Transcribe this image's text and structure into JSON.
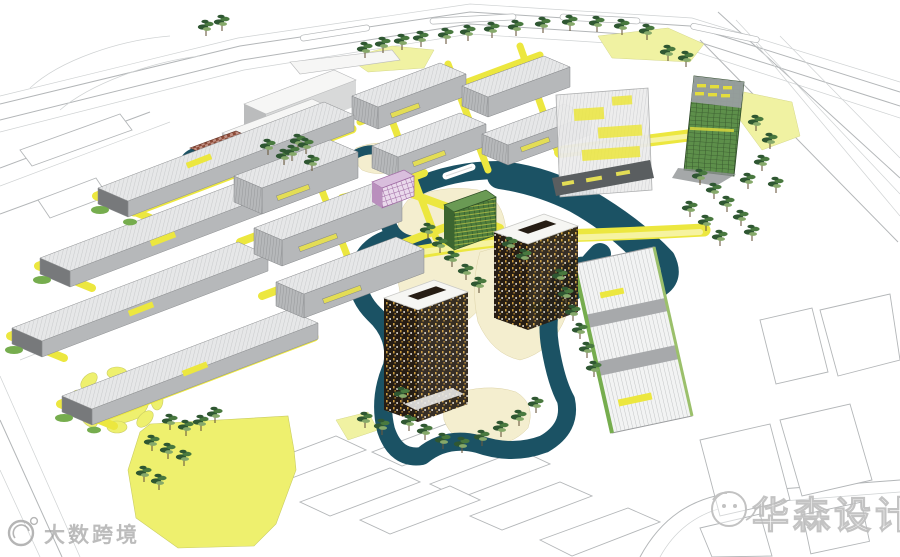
{
  "watermarks": {
    "bottom_left_text": "大数跨境",
    "bottom_right_text": "华森设计",
    "bottom_left_logo": "swirl-circle-logo",
    "bottom_right_logo": "face-circle-logo"
  },
  "scene": {
    "kind": "aerial-3d-masterplan-rendering",
    "elements": [
      "perimeter-roads-linework",
      "warehouse-district",
      "midrise-cluster",
      "top-cluster",
      "white-massing-buildings",
      "red-lattice-pavilion",
      "pink-lattice-cube",
      "green-lattice-cube",
      "meandering-river",
      "pond-island",
      "dark-courtyard-tower-upper",
      "dark-courtyard-tower-lower",
      "exhibition-slab",
      "green-glass-tower",
      "ribbed-hall-building",
      "yellow-walkway-network",
      "flower-plaza",
      "big-lawn",
      "tree-rows",
      "future-phase-parcel-outlines"
    ]
  },
  "colors": {
    "line_gray": "#b3b6b8",
    "line_light": "#cfd2d3",
    "water": "#1b5264",
    "path_yellow": "#ece73f",
    "path_yellow_light": "#f6f3a0",
    "lawn_yellow": "#eef06e",
    "lawn_pale": "#f0f2a2",
    "cream": "#f4eecf",
    "green_strip": "#76ad4e",
    "tree_dark": "#2f5732",
    "tree_mid": "#49793f",
    "tree_light": "#86a96a",
    "trunk": "#6b5a3f",
    "roof_light": "#e6e7e8",
    "roof_stripe": "#c9cbcc",
    "face_gray": "#b6b8ba",
    "end_dark": "#77797b",
    "white_bldg": "#f6f6f5",
    "white_bldg_shade": "#d8d9d9",
    "dark_facade": "#261d14",
    "speckle_gold": "#c99b3f",
    "speckle_white": "#e9e4da",
    "glass_green": "#5d8f4a",
    "glass_dark": "#39592f",
    "pink": "#9f6aa3",
    "pink_light": "#ead9ec",
    "red_brown": "#8c4a37",
    "red_brown_light": "#c29285",
    "slab_dark": "#5a5e60",
    "watermark_gray": "#9d9d9d",
    "watermark_outline": "#bdbdbd"
  }
}
